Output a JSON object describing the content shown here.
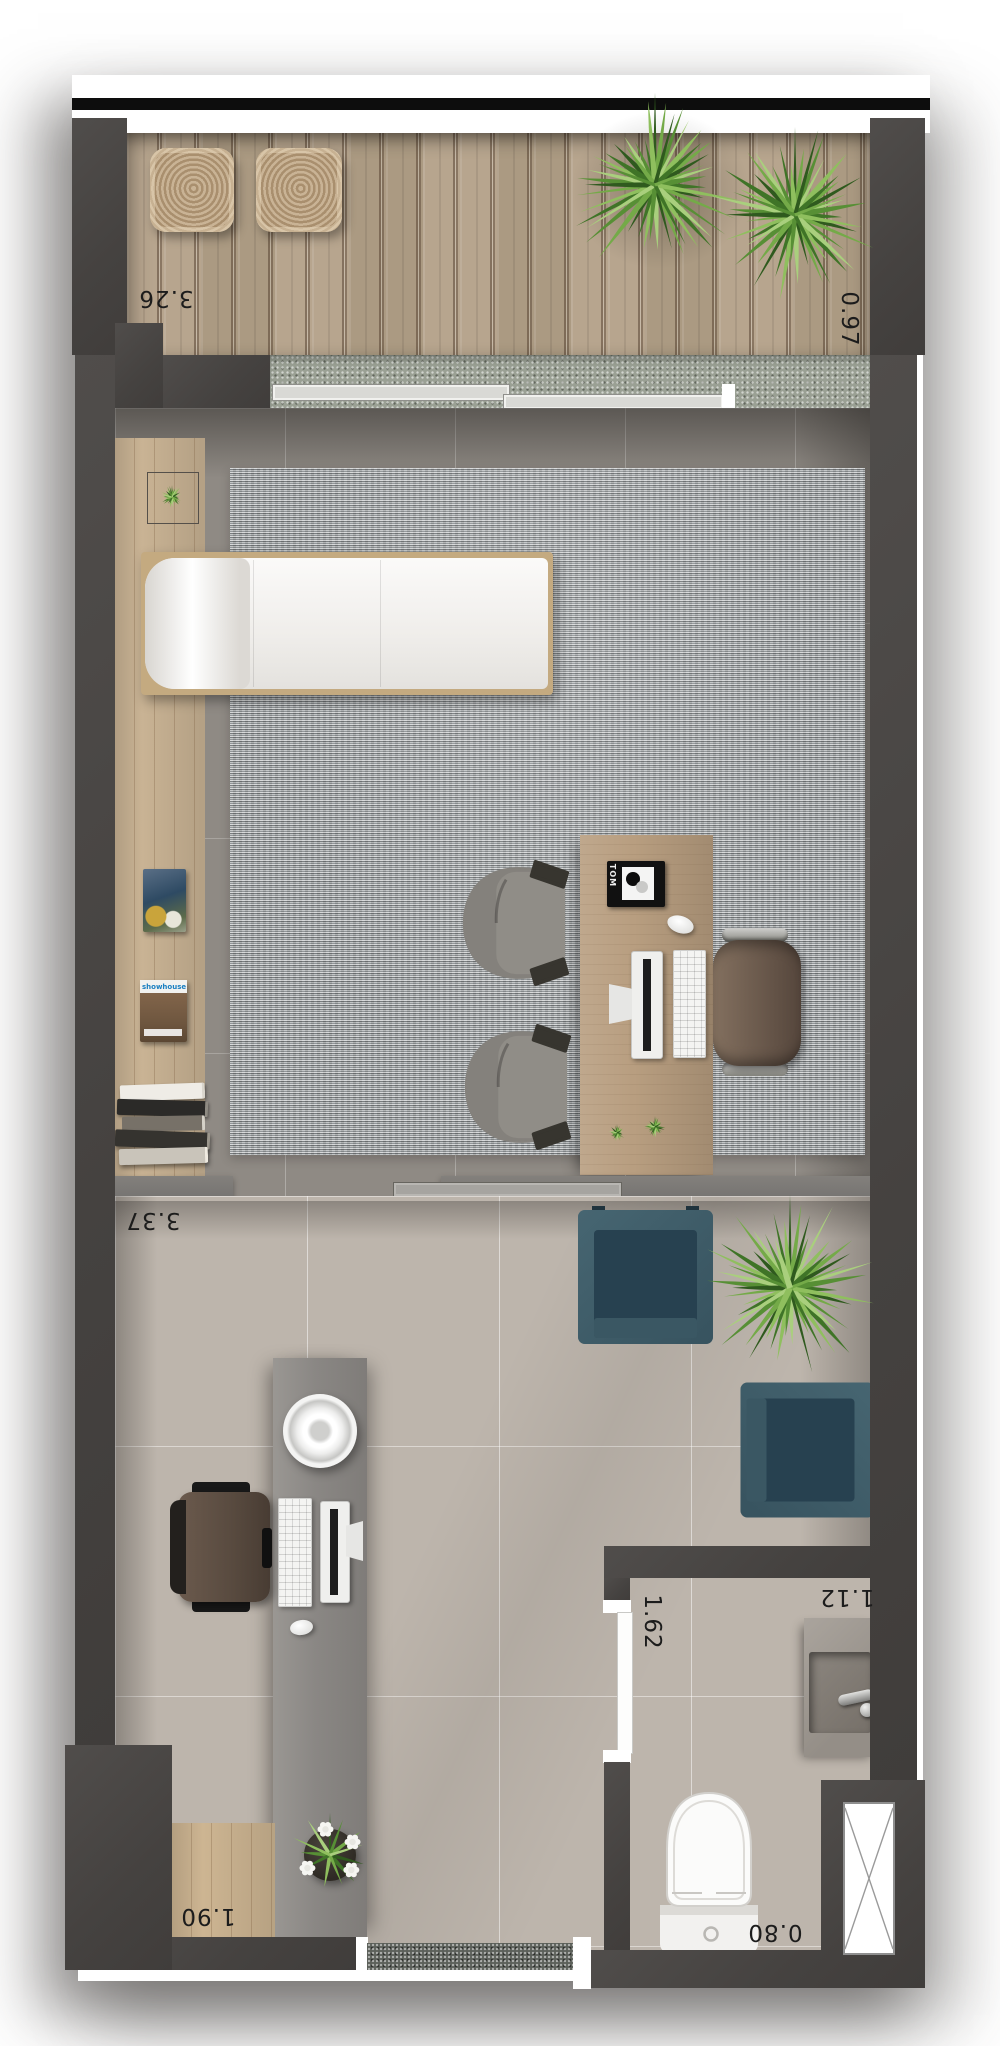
{
  "plan": {
    "type": "studio apartment floor plan, top view render",
    "dimension_labels": {
      "balcony_width": "3.26",
      "balcony_depth": "0.97",
      "living_room_width": "3.37",
      "bath_corridor_length": "1.62",
      "washbasin_width": "1.12",
      "toilet_width": "0.80",
      "entry_nook_width": "1.90"
    },
    "texts": {
      "magazine_masthead": "showhouse",
      "desk_book_spine": "TOM"
    },
    "colors": {
      "wall": "#4a4745",
      "partition": "#7d7a76",
      "deck_wood": "#b2a089",
      "bench_wood": "#c9b394",
      "desk_wood": "#b89e80",
      "rug": "#a9adaf",
      "upper_floor_tile": "#8f8a84",
      "lower_floor_tile": "#bdb5ac",
      "granite_sill": "#9aa094",
      "entry_mat": "#5c605a",
      "teal_armchair": "#3f5a66",
      "plant_green": "#4e7a33",
      "section_line": "#0d0d0d",
      "label_text": "#1c1c1c"
    },
    "rooms": [
      {
        "name": "balcony"
      },
      {
        "name": "living-office"
      },
      {
        "name": "lobby"
      },
      {
        "name": "bathroom"
      },
      {
        "name": "entry"
      }
    ]
  }
}
